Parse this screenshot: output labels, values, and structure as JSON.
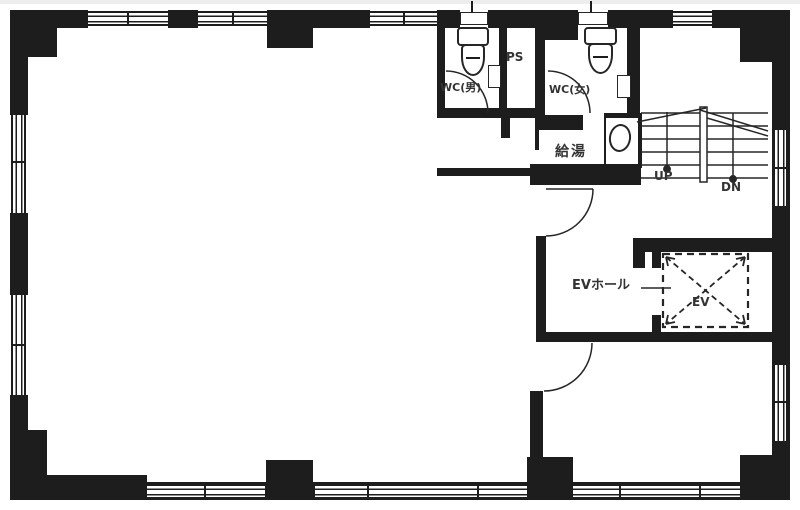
{
  "plan": {
    "rooms": {
      "wc_men": "WC(男)",
      "ps": "PS",
      "wc_women": "WC(女)",
      "kitchenette": "給湯",
      "elevator_hall": "EVホール",
      "elevator": "EV"
    },
    "stairs": {
      "up": "UP",
      "down": "DN"
    },
    "colors": {
      "wall": "#1d1d1d",
      "line": "#2a2a2a",
      "text": "#333333",
      "background": "#ffffff"
    }
  }
}
